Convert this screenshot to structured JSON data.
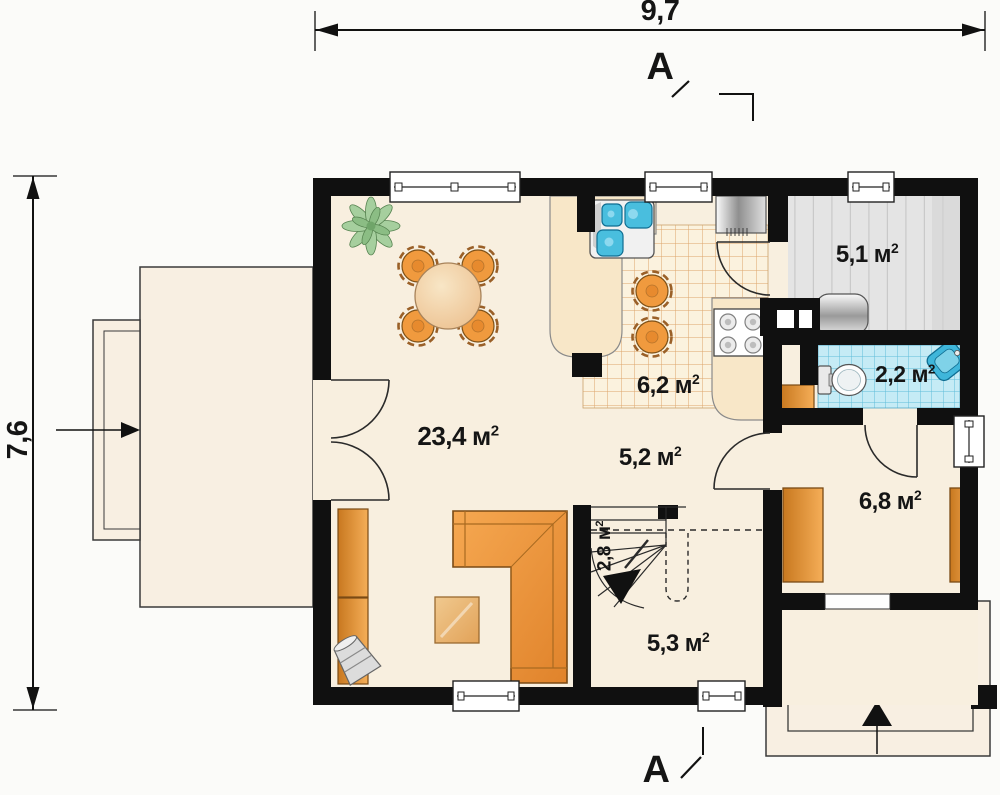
{
  "dimensions": {
    "width": "9,7",
    "height": "7,6"
  },
  "section_mark": "A",
  "unit": {
    "symbol": "м",
    "exponent": "2"
  },
  "rooms": [
    {
      "id": "living-room",
      "area": "23,4"
    },
    {
      "id": "kitchen",
      "area": "6,2"
    },
    {
      "id": "utility-room",
      "area": "5,1"
    },
    {
      "id": "bathroom",
      "area": "2,2"
    },
    {
      "id": "hallway",
      "area": "5,2"
    },
    {
      "id": "staircase",
      "area": "2,8"
    },
    {
      "id": "vestibule",
      "area": "6,8"
    },
    {
      "id": "entry-room",
      "area": "5,3"
    }
  ],
  "colors": {
    "wall": "#101010",
    "floor": "#f8efdf",
    "counter": "#f8e7c8",
    "kitchen_tile_line": "#dca46b",
    "bathroom_tile": "#c5ebf5",
    "bathroom_tile_line": "#5fbcd9",
    "utility_floor": "#e4e4e4",
    "furniture_orange": "#ef9440",
    "fixture_blue": "#3fb6da",
    "table_wood": "#eec293",
    "plant_green": "#9cc795"
  }
}
